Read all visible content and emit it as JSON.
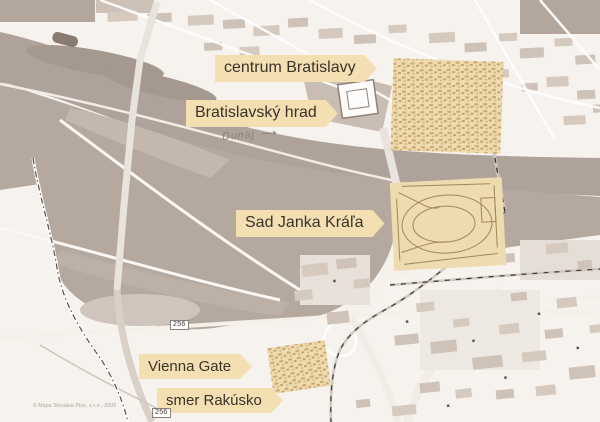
{
  "map": {
    "labels": [
      {
        "id": "centrum",
        "text": "centrum Bratislavy"
      },
      {
        "id": "hrad",
        "text": "Bratislavský hrad"
      },
      {
        "id": "sad",
        "text": "Sad Janka Kráľa"
      },
      {
        "id": "vienna",
        "text": "Vienna Gate"
      },
      {
        "id": "rakusko",
        "text": "smer Rakúsko"
      }
    ],
    "river_label": {
      "text": "Dunaj",
      "arrow": "⟶"
    },
    "road_badges": [
      {
        "text": "256"
      },
      {
        "text": "256"
      }
    ],
    "copyright": "© Mapa Slovakia Plus, s.r.o., 2005"
  },
  "colors": {
    "bg": "#f6f2ee",
    "river": "#aea29a",
    "land": "#b5a89f",
    "land_light": "#c3b7ae",
    "block": "#d6cabf",
    "block2": "#cfc2b8",
    "block_dark": "#b3a69d",
    "road": "#faf7f4",
    "highlight": "#eedbb0",
    "highlight_detail": "#cdab74",
    "park_line": "#a3875a",
    "banner_bg": "#f3dfb2",
    "banner_text": "#3a332c",
    "muted_text": "#8d8279",
    "badge_border": "#8a8178",
    "copyright": "#aaa29a"
  }
}
